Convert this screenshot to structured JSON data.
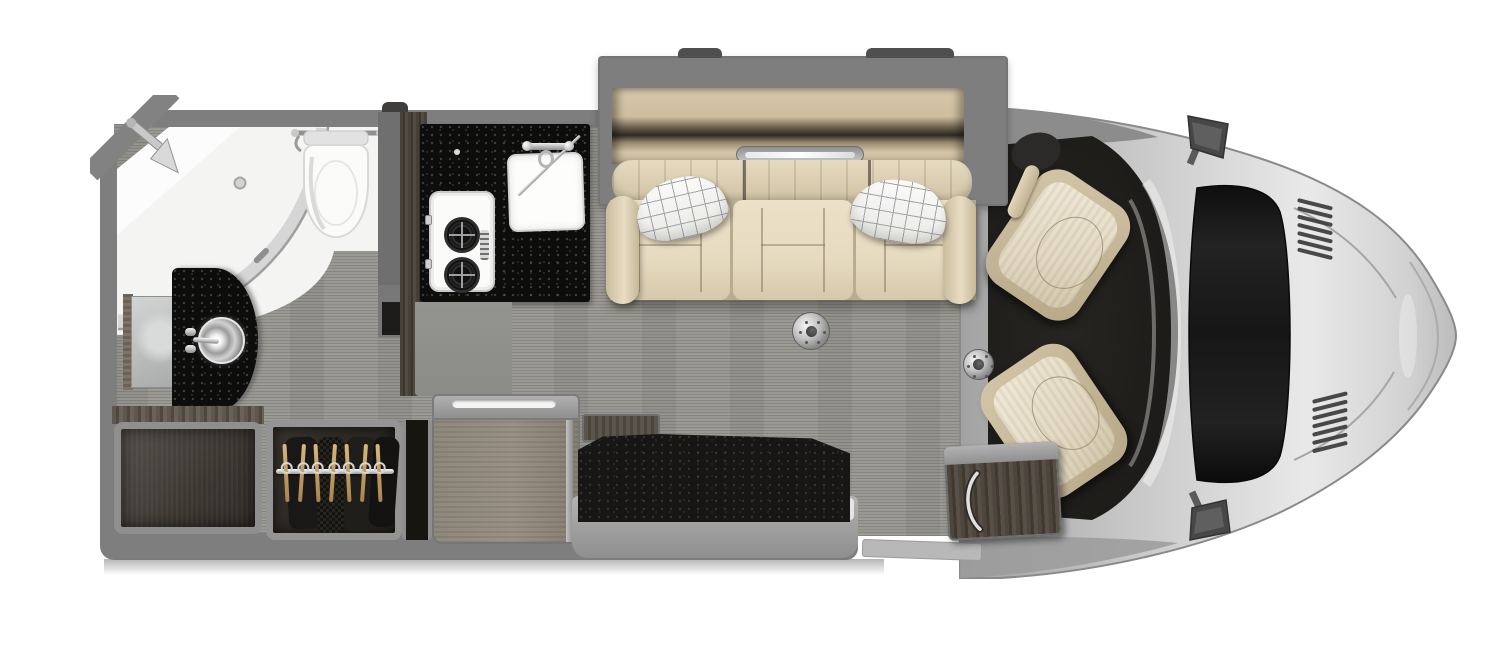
{
  "colors": {
    "wall_gray": "#7e7e7e",
    "floor_base": "#9a9892",
    "counter_black": "#0d0d0c",
    "cream": "#e6dac0",
    "pillow_grid": "#a2a2a8",
    "body_silver": "#c9c9c9",
    "body_edge": "#8f8f8f",
    "cab_carpet": "#201f1d",
    "wood_dark": "#4a443c",
    "wood_light": "#8f867a",
    "chrome": "#c4c4c4",
    "fixture_white": "#f5f5f4",
    "tan_cabinet": "#d5c6a8",
    "mirror_dark": "#474747"
  },
  "floorplan": {
    "view": "top-down motorhome floor plan",
    "rooms": [
      {
        "name": "wet-bath",
        "fixtures": [
          "corner-shower",
          "shower-head",
          "shower-drain",
          "glass-door",
          "towel-bar",
          "toilet",
          "vanity-vessel-sink",
          "vanity-faucet",
          "mirror-cabinet"
        ]
      },
      {
        "name": "galley",
        "fixtures": [
          "black-countertop",
          "two-burner-cooktop",
          "square-sink",
          "faucet",
          "pantry-wall"
        ]
      },
      {
        "name": "lounge",
        "fixtures": [
          "slide-out",
          "overhead-cabinet",
          "led-light-strip",
          "three-seat-sofa",
          "throw-pillow-left",
          "throw-pillow-right",
          "table-floor-mount-rear",
          "table-floor-mount-front"
        ]
      },
      {
        "name": "storage",
        "fixtures": [
          "open-cubby",
          "hanging-wardrobe",
          "wardrobe-rod",
          "dresser-cabinet"
        ]
      },
      {
        "name": "entry",
        "fixtures": [
          "entry-mat",
          "entry-step",
          "entry-shelf"
        ]
      },
      {
        "name": "cab",
        "fixtures": [
          "driver-swivel-seat",
          "passenger-swivel-seat",
          "steering-wheel",
          "side-mirror-top",
          "side-mirror-bottom",
          "hood",
          "hood-vents",
          "front-console-cabinet"
        ]
      }
    ],
    "wardrobe": {
      "hanger_count": 7
    }
  }
}
